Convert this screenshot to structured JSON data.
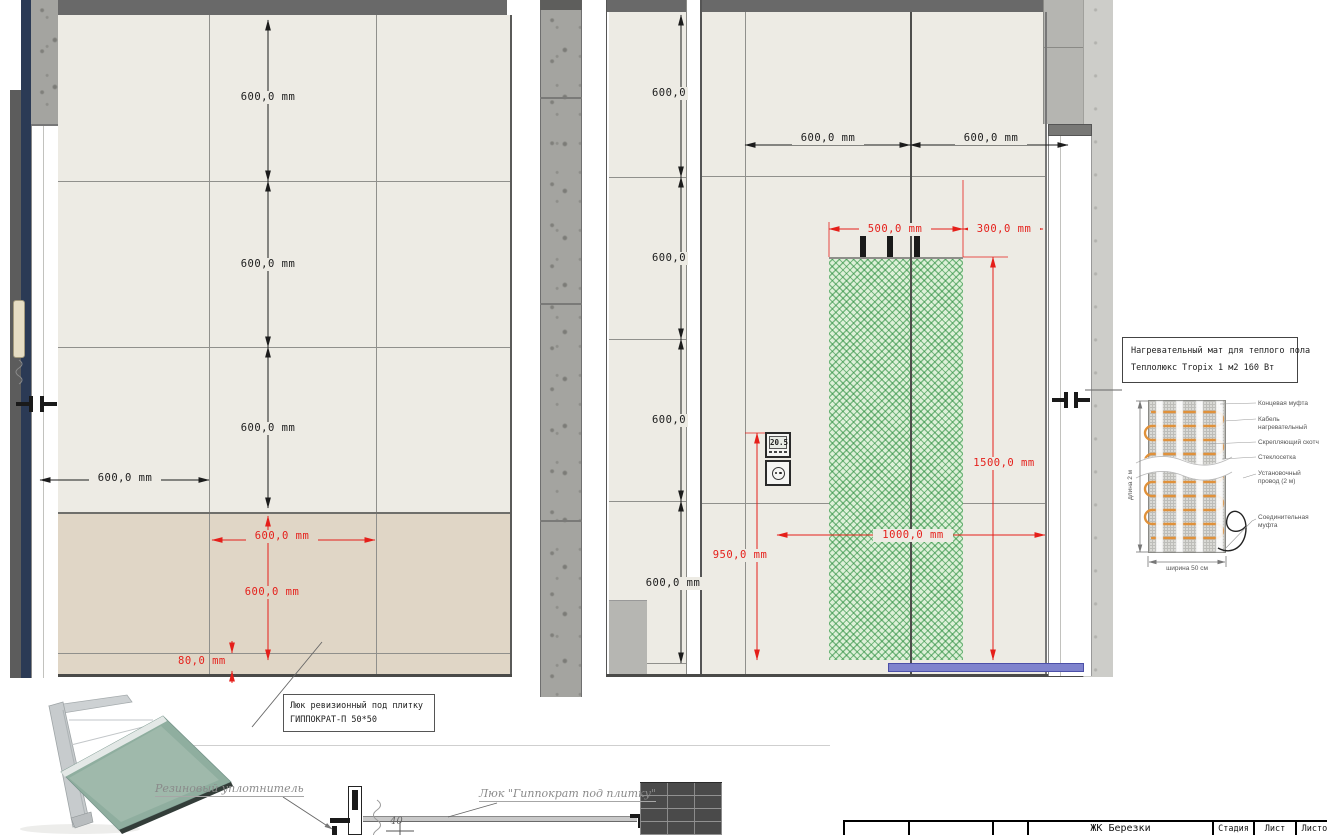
{
  "left_elevation": {
    "dims_vertical": [
      "600,0 mm",
      "600,0 mm",
      "600,0 mm"
    ],
    "dim_horizontal": "600,0 mm",
    "dim_red_horizontal": "600,0 mm",
    "dim_red_vertical": "600,0 mm",
    "dim_red_bottom": "80,0 mm",
    "hatch_callout": {
      "line1": "Люк ревизионный под плитку",
      "line2": "ГИППОКРАТ-П 50*50"
    }
  },
  "right_elevation": {
    "dims_strip": [
      "600,0",
      "600,0",
      "600,0",
      "600,0 mm"
    ],
    "dims_horizontal": [
      "600,0 mm",
      "600,0 mm"
    ],
    "dim_red_500": "500,0 mm",
    "dim_red_300": "300,0 mm",
    "dim_red_1500": "1500,0 mm",
    "dim_red_950": "950,0 mm",
    "dim_red_1000": "1000,0 mm",
    "thermostat_value": "20.5"
  },
  "heating_mat_legend": {
    "title_line1": "Нагревательный мат для теплого пола",
    "title_line2": "Теплолюкс Tropix 1 м2 160 Вт",
    "labels": [
      "Концевая муфта",
      "Кабель нагревательный",
      "Скрепляющий скотч",
      "Стеклосетка",
      "Установочный провод (2 м)",
      "Соединительная муфта"
    ],
    "dim_length": "длина 2 м",
    "dim_width": "ширина 50 см"
  },
  "section_detail": {
    "label_seal": "Резиновый уплотнитель",
    "label_hatch": "Люк \"Гиппократ под плитку\"",
    "dim_40": "40"
  },
  "title_block": {
    "project": "ЖК Березки",
    "columns": [
      "Стадия",
      "Лист",
      "Листов"
    ]
  },
  "colors": {
    "dim_red": "#e51f1a",
    "mat_green": "#2e8b46",
    "baseboard_purple": "#7f83cd",
    "navy": "#2b3a55"
  }
}
